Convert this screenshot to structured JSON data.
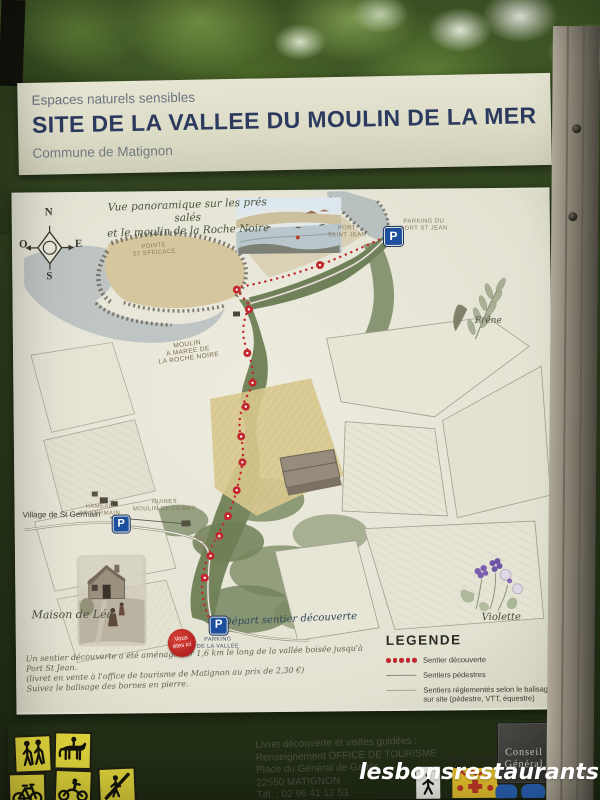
{
  "photo": {
    "watermark": "lesbonsrestaurants"
  },
  "sign": {
    "header": {
      "tagline": "Espaces naturels sensibles",
      "title": "SITE DE LA VALLEE DU MOULIN DE LA MER",
      "commune": "Commune de Matignon"
    },
    "map": {
      "caption_line1": "Vue panoramique sur les prés salés",
      "caption_line2": "et le moulin de la Roche Noire",
      "compass": {
        "north": "N",
        "west": "O",
        "east": "E",
        "south": "S"
      },
      "parking_letter": "P",
      "labels": {
        "pointe_line1": "POINTE",
        "pointe_line2": "ST EFFICACE",
        "port_line1": "PORT",
        "port_line2": "SAINT JEAN",
        "parking_port_line1": "PARKING DU",
        "parking_port_line2": "PORT ST JEAN",
        "moulin_maree_line1": "MOULIN",
        "moulin_maree_line2": "A MAREE DE",
        "moulin_maree_line3": "LA ROCHE NOIRE",
        "hameau_line1": "HAMEAU",
        "hameau_line2": "ST GERMAIN",
        "ruines_line1": "RUINES",
        "ruines_line2": "MOULIN DE LA MER",
        "maison_lea_line1": "MAISON",
        "maison_lea_line2": "DE LEA",
        "village_st_germain": "Village de St Germain",
        "maison_de_lea": "Maison de Léa",
        "frene": "Frêne",
        "violette": "Violette",
        "depart": "Départ sentier découverte",
        "parking_vallee_line1": "PARKING",
        "parking_vallee_line2": "DE LA VALLEE",
        "you_are_here_line1": "Vous",
        "you_are_here_line2": "êtes ici"
      },
      "notice_line1": "Un sentier découverte a été aménagé sur 1,6 km le long de la vallée boisée jusqu'à Port St Jean.",
      "notice_line2": "(livret en vente à l'office de tourisme de Matignon au prix de 2,30 €)",
      "notice_line3": "Suivez le balisage des bornes en pierre.",
      "legend": {
        "title": "LEGENDE",
        "items": [
          {
            "label": "Sentier découverte"
          },
          {
            "label": "Sentiers pédestres"
          },
          {
            "label": "Sentiers réglementés selon le balisage",
            "label2": "sur site (pédestre, VTT, équestre)"
          }
        ]
      }
    },
    "footer": {
      "contact_line1": "Livret découverte et visites guidées :",
      "contact_line2": "Renseignement OFFICE DE TOURISME",
      "contact_line3": "Place du Général de Gaulle",
      "contact_line4": "22550 MATIGNON",
      "contact_line5": "Tél. : 02 96 41 12 53",
      "conseil_line1": "Conseil",
      "conseil_line2": "Général",
      "matignon": "MATIGNON",
      "pictograms": [
        "hikers",
        "horse-riding",
        "cycling",
        "motorcycling",
        "restricted-use"
      ]
    }
  },
  "colors": {
    "sign_cream": "#dddcc8",
    "title_navy": "#2b3a5e",
    "trail_red": "#c1272d",
    "parking_blue": "#1d4f9e",
    "pictogram_yellow": "#ddd23a",
    "map_green": "#74855c",
    "field_tan": "#d5c69e",
    "water_grey": "#b7bec0"
  }
}
